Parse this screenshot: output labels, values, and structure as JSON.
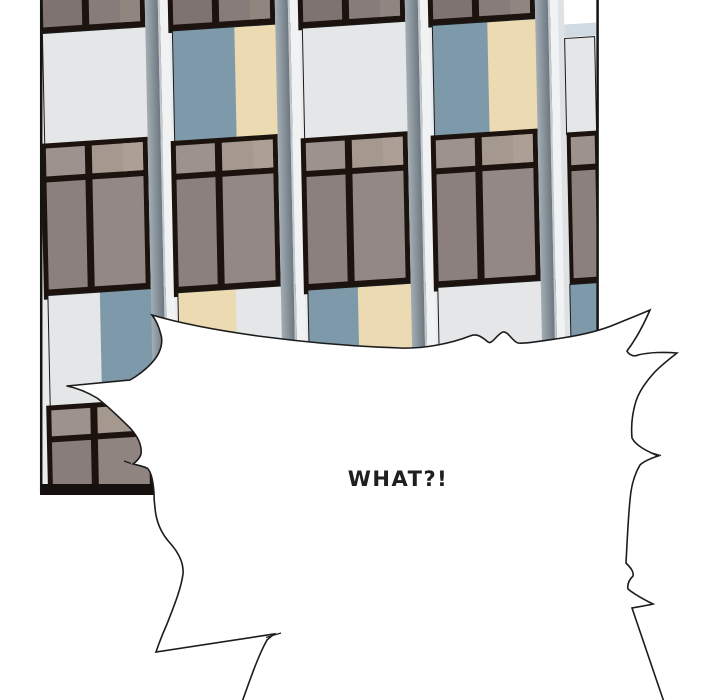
{
  "panel": {
    "background": "#ffffff",
    "border_color": "#141414",
    "building": {
      "colors": {
        "facade_bg": "#e9ebec",
        "frame": "#1c130f",
        "outline": "#1a1a1a",
        "pane_top_left": "#7e7371",
        "pane_top_right": "#877c79",
        "pane_top_corner": "#91867f",
        "pane_transom_left": "#9e928e",
        "pane_transom_right": "#a5988f",
        "pane_transom_corner": "#ad9f95",
        "pane_main_left": "#8b807d",
        "pane_main_right": "#938885",
        "pane_bot_left": "#887d7a",
        "pane_bot_right": "#8f8480",
        "spandrel_white": "#e4e6e8",
        "spandrel_blue": "#7e99aa",
        "spandrel_cream": "#ecdab3",
        "column_grad_light": "#a2adb4",
        "column_grad_dark": "#6d7780",
        "white_strip": "#f1f2f3",
        "strip_edge": "#c3c8cc",
        "bay5_strip": "#dfe2e5",
        "sky_white": "#ffffff",
        "sky_blue": "#d0dbe4",
        "bottom_bar": "#15100d"
      },
      "bays": [
        {
          "name": "facade-bay-1",
          "cut": false,
          "spandrel_top": {
            "left": "white",
            "right": "white",
            "split": 60
          },
          "spandrel_bottom": {
            "left": "white",
            "right": "blue",
            "split": 52
          }
        },
        {
          "name": "facade-bay-2",
          "cut": false,
          "spandrel_top": {
            "left": "blue",
            "right": "cream",
            "split": 62
          },
          "spandrel_bottom": {
            "left": "cream",
            "right": "white",
            "split": 58
          }
        },
        {
          "name": "facade-bay-3",
          "cut": false,
          "spandrel_top": {
            "left": "white",
            "right": "white",
            "split": 60
          },
          "spandrel_bottom": {
            "left": "blue",
            "right": "cream",
            "split": 50
          }
        },
        {
          "name": "facade-bay-4",
          "cut": false,
          "spandrel_top": {
            "left": "blue",
            "right": "cream",
            "split": 55
          },
          "spandrel_bottom": {
            "left": "white",
            "right": "white",
            "split": 60
          }
        },
        {
          "name": "facade-bay-5",
          "cut": true,
          "spandrel_top": {
            "left": "white",
            "right": "white",
            "split": 60
          },
          "spandrel_bottom": {
            "left": "blue",
            "right": "blue",
            "split": 60
          }
        }
      ]
    }
  },
  "speech_bubble": {
    "text": "WHAT?!",
    "fill": "#ffffff",
    "stroke": "#1c1c1c",
    "text_color": "#1f1f1f"
  }
}
